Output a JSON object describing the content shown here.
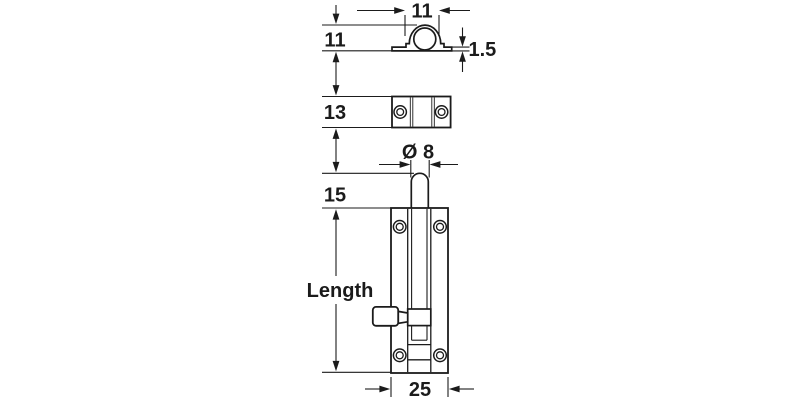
{
  "drawing": {
    "kind": "technical dimension drawing",
    "part": "barrel bolt with keeper",
    "labels": {
      "keeper_arch_width": "11",
      "keeper_profile_height": "11",
      "keeper_base_thickness": "1.5",
      "keeper_plate_depth": "13",
      "bolt_diameter": "Ø 8",
      "pin_protrusion": "15",
      "body_length": "Length",
      "body_width": "25"
    },
    "colors": {
      "line": "#1b1b1b",
      "background": "#ffffff"
    }
  }
}
